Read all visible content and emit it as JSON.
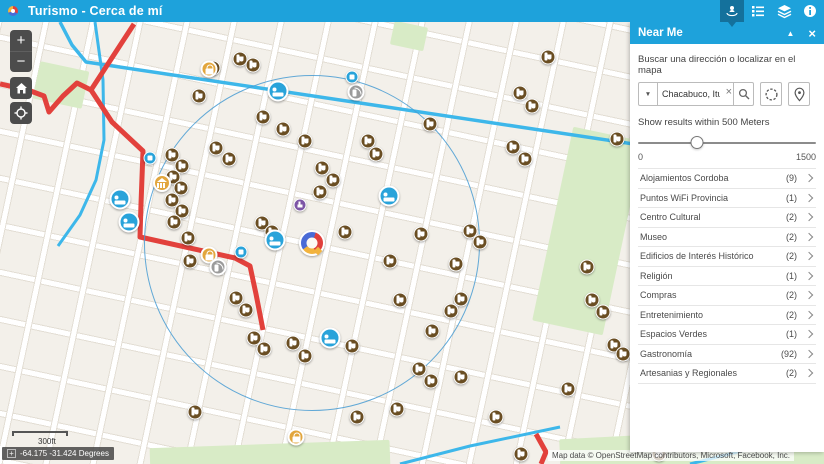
{
  "header": {
    "title": "Turismo - Cerca de mí",
    "tools": [
      {
        "icon": "near-me-icon",
        "active": true
      },
      {
        "icon": "legend-icon",
        "active": false
      },
      {
        "icon": "layers-icon",
        "active": false
      },
      {
        "icon": "info-icon",
        "active": false
      }
    ]
  },
  "map_controls": {
    "zoom_in": "+",
    "zoom_out": "−"
  },
  "panel": {
    "title": "Near Me",
    "fold_icon": "▲",
    "close_icon": "×",
    "search_label": "Buscar una dirección o localizar en el mapa",
    "dropdown_icon": "▼",
    "search_value": "Chacabuco, Ituzaing",
    "clear_icon": "×",
    "slider_label": "Show results within 500 Meters",
    "slider_min_label": "0",
    "slider_max_label": "1500",
    "slider_value": 500,
    "slider_max": 1500,
    "categories": [
      {
        "label": "Alojamientos Cordoba",
        "count": "(9)"
      },
      {
        "label": "Puntos WiFi Provincia",
        "count": "(1)"
      },
      {
        "label": "Centro Cultural",
        "count": "(2)"
      },
      {
        "label": "Museo",
        "count": "(2)"
      },
      {
        "label": "Edificios de Interés Histórico",
        "count": "(2)"
      },
      {
        "label": "Religión",
        "count": "(1)"
      },
      {
        "label": "Compras",
        "count": "(2)"
      },
      {
        "label": "Entretenimiento",
        "count": "(2)"
      },
      {
        "label": "Espacios Verdes",
        "count": "(1)"
      },
      {
        "label": "Gastronomía",
        "count": "(92)"
      },
      {
        "label": "Artesanias y Regionales",
        "count": "(2)"
      }
    ]
  },
  "map": {
    "scale_label": "300ft",
    "coords_plus": "+",
    "coordinates": "-64.175 -31.424 Degrees",
    "attribution": "Map data © OpenStreetMap contributors, Microsoft, Facebook, Inc.",
    "colors": {
      "accent": "#1ea2db",
      "active_tool": "#14719c",
      "route_red": "#e2413c",
      "route_cyan": "#3db7ea",
      "radius_circle": "#4a9bd2",
      "gastro": "#6a4e23",
      "hotel": "#29a3da",
      "shop": "#e2a63d",
      "wifi": "#9b9b9b",
      "religion": "#7d55a6"
    },
    "markers": [
      {
        "x": 213,
        "y": 68,
        "t": "gastro"
      },
      {
        "x": 240,
        "y": 59,
        "t": "gastro"
      },
      {
        "x": 253,
        "y": 65,
        "t": "gastro"
      },
      {
        "x": 199,
        "y": 96,
        "t": "gastro"
      },
      {
        "x": 216,
        "y": 148,
        "t": "gastro"
      },
      {
        "x": 229,
        "y": 159,
        "t": "gastro"
      },
      {
        "x": 172,
        "y": 155,
        "t": "gastro"
      },
      {
        "x": 182,
        "y": 166,
        "t": "gastro"
      },
      {
        "x": 173,
        "y": 177,
        "t": "gastro"
      },
      {
        "x": 181,
        "y": 188,
        "t": "gastro"
      },
      {
        "x": 172,
        "y": 200,
        "t": "gastro"
      },
      {
        "x": 182,
        "y": 211,
        "t": "gastro"
      },
      {
        "x": 174,
        "y": 222,
        "t": "gastro"
      },
      {
        "x": 188,
        "y": 238,
        "t": "gastro"
      },
      {
        "x": 190,
        "y": 261,
        "t": "gastro"
      },
      {
        "x": 263,
        "y": 117,
        "t": "gastro"
      },
      {
        "x": 283,
        "y": 129,
        "t": "gastro"
      },
      {
        "x": 305,
        "y": 141,
        "t": "gastro"
      },
      {
        "x": 322,
        "y": 168,
        "t": "gastro"
      },
      {
        "x": 333,
        "y": 180,
        "t": "gastro"
      },
      {
        "x": 320,
        "y": 192,
        "t": "gastro"
      },
      {
        "x": 262,
        "y": 223,
        "t": "gastro"
      },
      {
        "x": 272,
        "y": 232,
        "t": "gastro"
      },
      {
        "x": 345,
        "y": 232,
        "t": "gastro"
      },
      {
        "x": 368,
        "y": 141,
        "t": "gastro"
      },
      {
        "x": 376,
        "y": 154,
        "t": "gastro"
      },
      {
        "x": 430,
        "y": 124,
        "t": "gastro"
      },
      {
        "x": 390,
        "y": 261,
        "t": "gastro"
      },
      {
        "x": 421,
        "y": 234,
        "t": "gastro"
      },
      {
        "x": 470,
        "y": 231,
        "t": "gastro"
      },
      {
        "x": 480,
        "y": 242,
        "t": "gastro"
      },
      {
        "x": 456,
        "y": 264,
        "t": "gastro"
      },
      {
        "x": 400,
        "y": 300,
        "t": "gastro"
      },
      {
        "x": 461,
        "y": 299,
        "t": "gastro"
      },
      {
        "x": 451,
        "y": 311,
        "t": "gastro"
      },
      {
        "x": 432,
        "y": 331,
        "t": "gastro"
      },
      {
        "x": 236,
        "y": 298,
        "t": "gastro"
      },
      {
        "x": 246,
        "y": 310,
        "t": "gastro"
      },
      {
        "x": 254,
        "y": 338,
        "t": "gastro"
      },
      {
        "x": 264,
        "y": 349,
        "t": "gastro"
      },
      {
        "x": 293,
        "y": 343,
        "t": "gastro"
      },
      {
        "x": 305,
        "y": 356,
        "t": "gastro"
      },
      {
        "x": 352,
        "y": 346,
        "t": "gastro"
      },
      {
        "x": 419,
        "y": 369,
        "t": "gastro"
      },
      {
        "x": 431,
        "y": 381,
        "t": "gastro"
      },
      {
        "x": 461,
        "y": 377,
        "t": "gastro"
      },
      {
        "x": 357,
        "y": 417,
        "t": "gastro"
      },
      {
        "x": 397,
        "y": 409,
        "t": "gastro"
      },
      {
        "x": 496,
        "y": 417,
        "t": "gastro"
      },
      {
        "x": 568,
        "y": 389,
        "t": "gastro"
      },
      {
        "x": 195,
        "y": 412,
        "t": "gastro"
      },
      {
        "x": 513,
        "y": 147,
        "t": "gastro"
      },
      {
        "x": 525,
        "y": 159,
        "t": "gastro"
      },
      {
        "x": 520,
        "y": 93,
        "t": "gastro"
      },
      {
        "x": 532,
        "y": 106,
        "t": "gastro"
      },
      {
        "x": 548,
        "y": 57,
        "t": "gastro"
      },
      {
        "x": 617,
        "y": 139,
        "t": "gastro"
      },
      {
        "x": 592,
        "y": 300,
        "t": "gastro"
      },
      {
        "x": 603,
        "y": 312,
        "t": "gastro"
      },
      {
        "x": 614,
        "y": 345,
        "t": "gastro"
      },
      {
        "x": 623,
        "y": 354,
        "t": "gastro"
      },
      {
        "x": 587,
        "y": 267,
        "t": "gastro"
      },
      {
        "x": 521,
        "y": 454,
        "t": "gastro"
      },
      {
        "x": 659,
        "y": 454,
        "t": "gastro"
      },
      {
        "x": 120,
        "y": 199,
        "t": "hotel"
      },
      {
        "x": 129,
        "y": 222,
        "t": "hotel"
      },
      {
        "x": 278,
        "y": 91,
        "t": "hotel"
      },
      {
        "x": 275,
        "y": 240,
        "t": "hotel"
      },
      {
        "x": 330,
        "y": 338,
        "t": "hotel"
      },
      {
        "x": 389,
        "y": 196,
        "t": "hotel"
      },
      {
        "x": 209,
        "y": 69,
        "t": "shop"
      },
      {
        "x": 209,
        "y": 255,
        "t": "shop"
      },
      {
        "x": 296,
        "y": 437,
        "t": "shop"
      },
      {
        "x": 162,
        "y": 183,
        "t": "historic"
      },
      {
        "x": 218,
        "y": 267,
        "t": "wifi"
      },
      {
        "x": 356,
        "y": 92,
        "t": "wifi"
      },
      {
        "x": 150,
        "y": 158,
        "t": "culture"
      },
      {
        "x": 241,
        "y": 252,
        "t": "culture"
      },
      {
        "x": 352,
        "y": 77,
        "t": "culture"
      },
      {
        "x": 300,
        "y": 205,
        "t": "religion"
      },
      {
        "x": 312,
        "y": 243,
        "t": "logo"
      }
    ]
  }
}
